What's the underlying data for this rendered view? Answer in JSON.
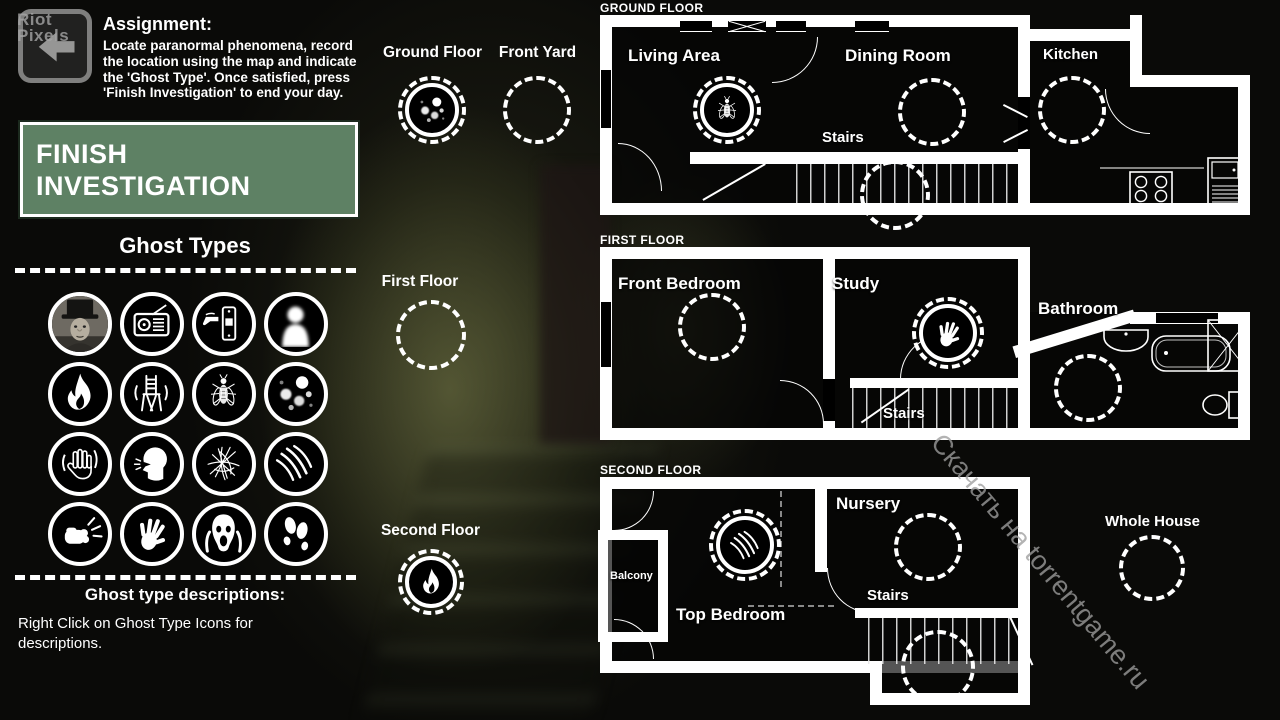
{
  "watermarks": {
    "riot_top": "Riot",
    "riot_bottom": "Pixels",
    "torrent": "Скачать на torrentgame.ru"
  },
  "assignment": {
    "title": "Assignment:",
    "body": "Locate paranormal phenomena, record the location using the map and indicate the 'Ghost Type'. Once satisfied, press 'Finish Investigation' to end your day."
  },
  "finish_button": {
    "label": "FINISH INVESTIGATION"
  },
  "ghost_types": {
    "heading": "Ghost Types",
    "icons": [
      "apparition-portrait",
      "radio",
      "light-switch",
      "full-body-apparition",
      "fire",
      "moving-chair",
      "flies",
      "orbs",
      "touch",
      "whisper",
      "scribbles",
      "claw-scratches",
      "punch",
      "handprint",
      "scream",
      "footprints"
    ],
    "descriptions_heading": "Ghost type descriptions:",
    "descriptions_hint": "Right Click on Ghost Type Icons for descriptions."
  },
  "map_markers": [
    {
      "label": "Ground Floor",
      "icon": "orbs"
    },
    {
      "label": "Front Yard",
      "icon": ""
    },
    {
      "label": "First Floor",
      "icon": ""
    },
    {
      "label": "Second Floor",
      "icon": "fire"
    }
  ],
  "floors": [
    {
      "title": "GROUND FLOOR",
      "rooms": [
        {
          "name": "Living Area",
          "icon": "flies"
        },
        {
          "name": "Dining Room",
          "icon": ""
        },
        {
          "name": "Stairs",
          "icon": ""
        },
        {
          "name": "Kitchen",
          "icon": ""
        }
      ]
    },
    {
      "title": "FIRST FLOOR",
      "rooms": [
        {
          "name": "Front Bedroom",
          "icon": ""
        },
        {
          "name": "Study",
          "icon": "handprint"
        },
        {
          "name": "Bathroom",
          "icon": ""
        },
        {
          "name": "Stairs",
          "icon": ""
        }
      ]
    },
    {
      "title": "SECOND FLOOR",
      "rooms": [
        {
          "name": "Balcony",
          "icon": ""
        },
        {
          "name": "Top Bedroom",
          "icon": "claw-scratches"
        },
        {
          "name": "Nursery",
          "icon": ""
        },
        {
          "name": "Stairs",
          "icon": ""
        },
        {
          "name": "Whole House",
          "icon": ""
        }
      ]
    }
  ],
  "colors": {
    "finish_button_green": "#5e8164",
    "wall": "#ffffff",
    "background": "#0a0a08",
    "watermark": "#9a9a9a"
  }
}
